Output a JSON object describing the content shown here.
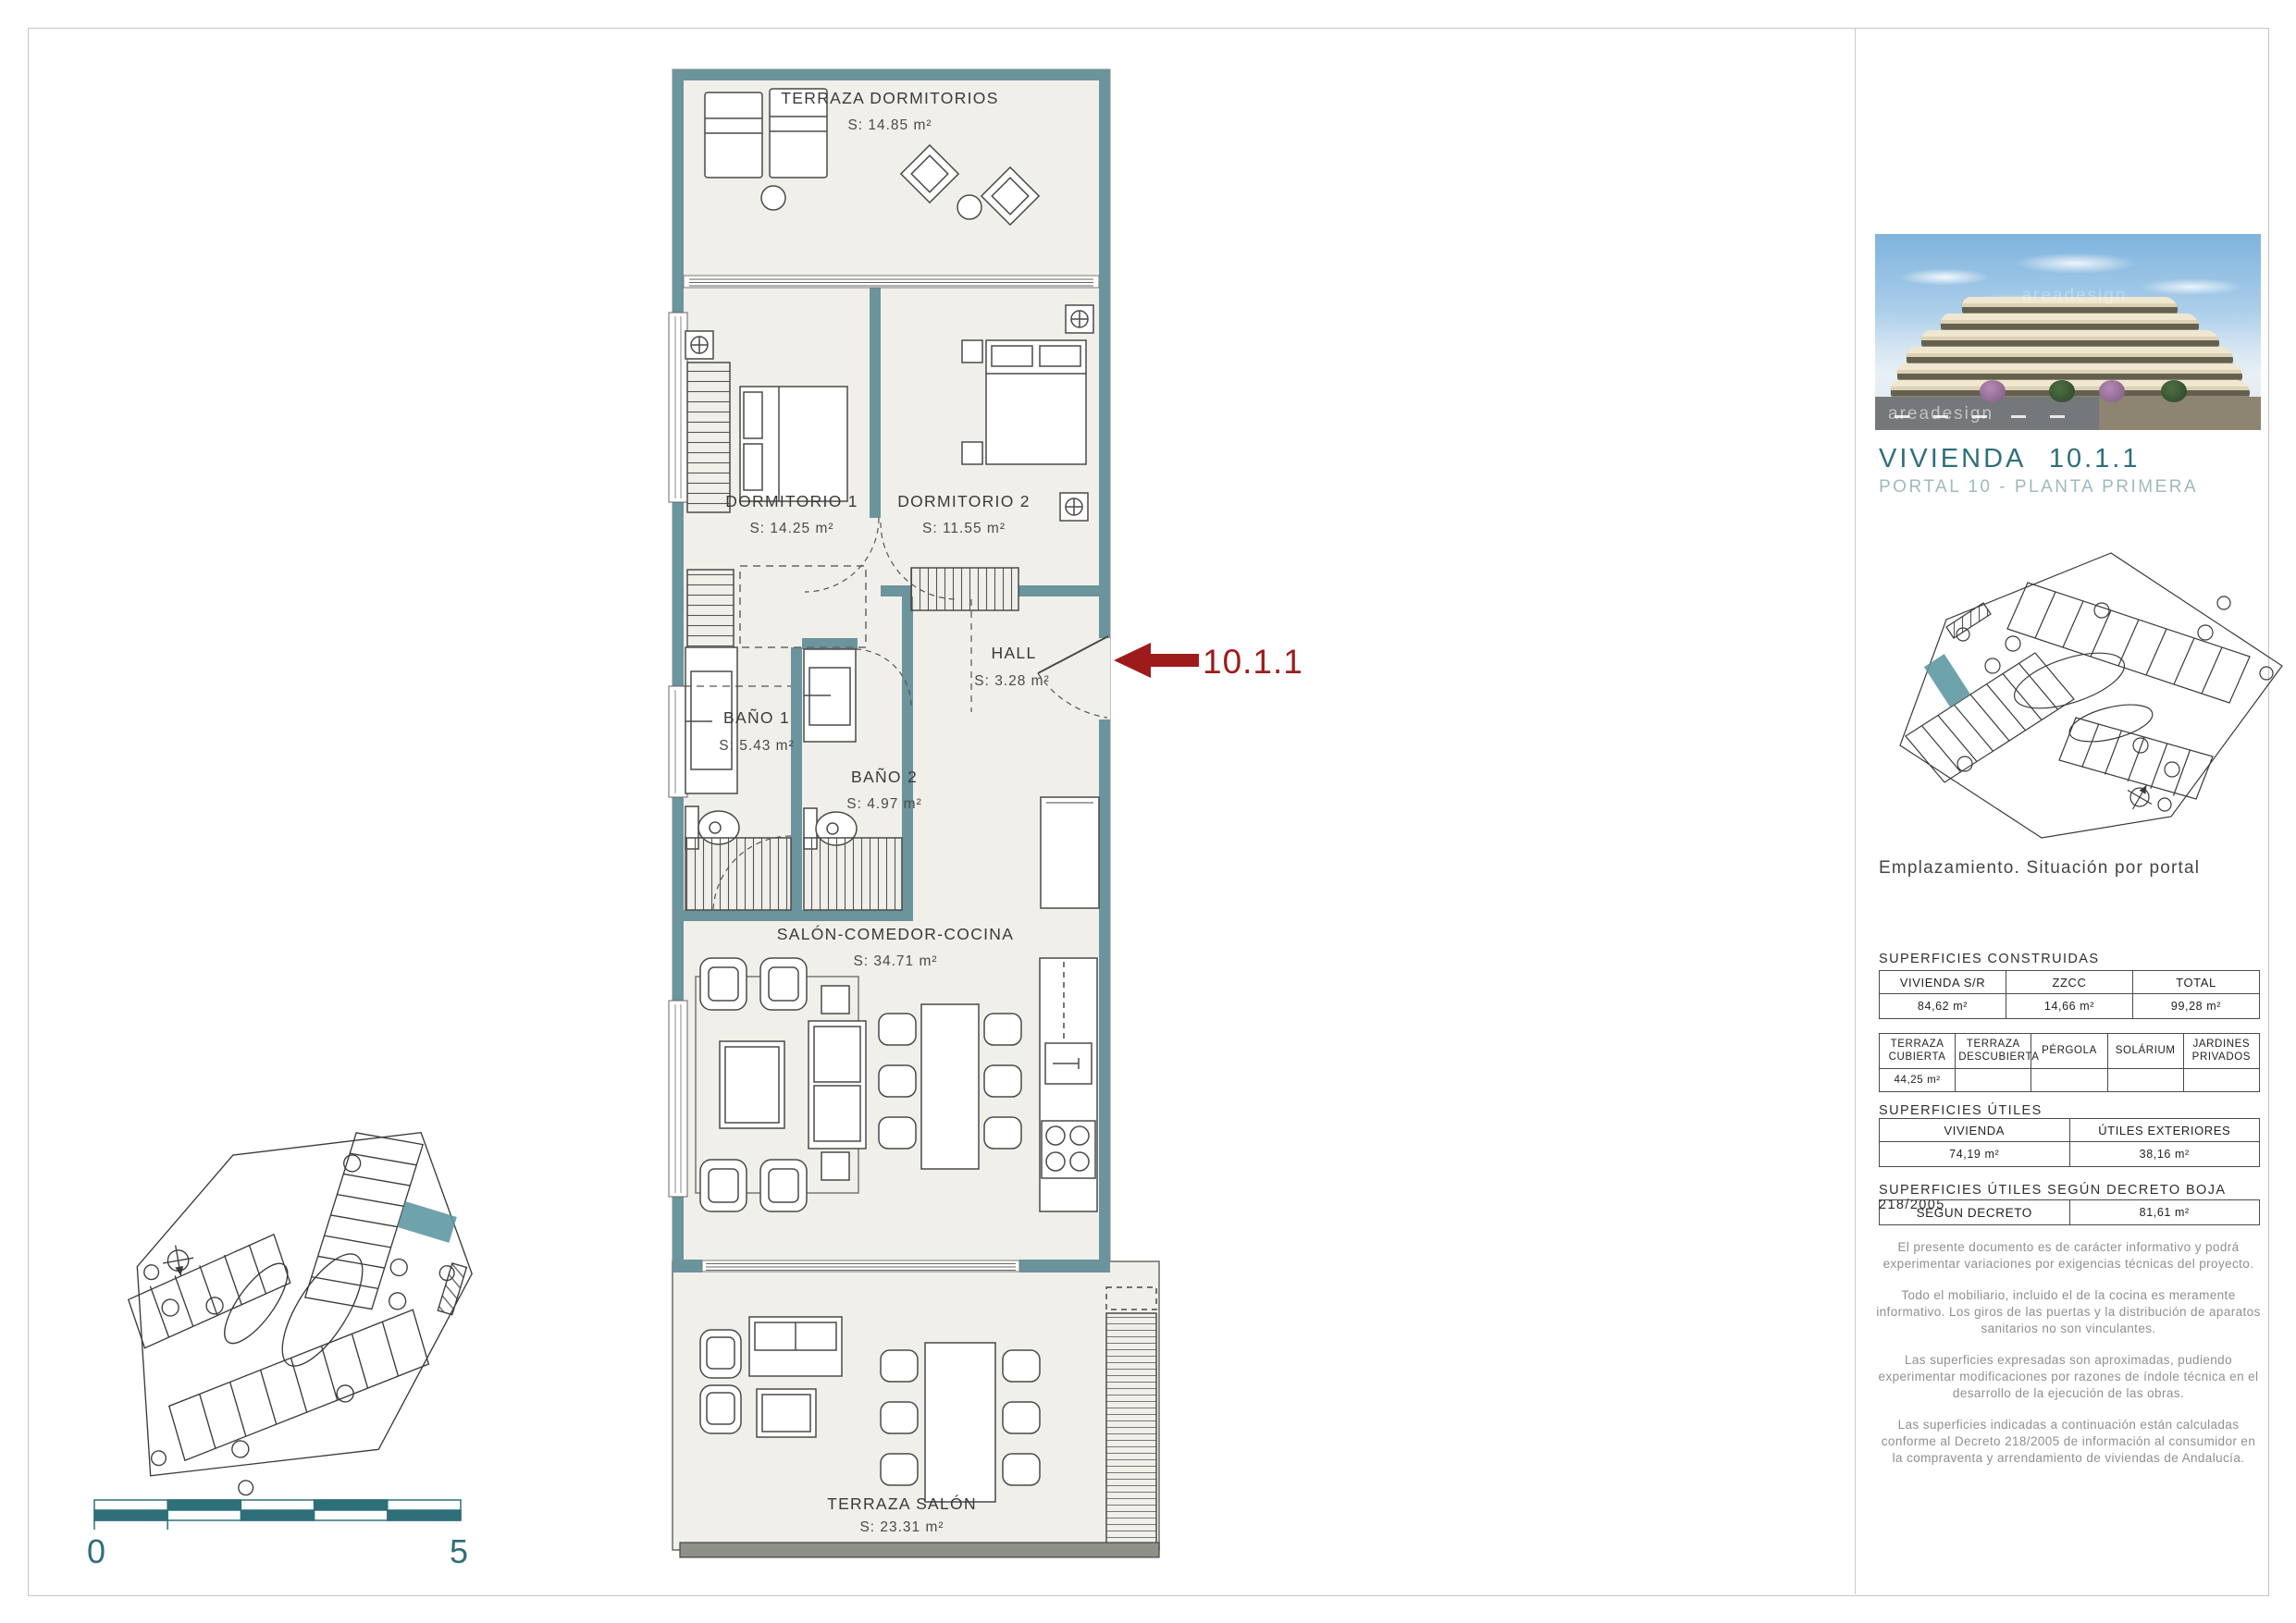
{
  "page": {
    "watermark": "areadesign"
  },
  "panel": {
    "title": "VIVIENDA",
    "unit": "10.1.1",
    "subtitle": "PORTAL 10 - PLANTA PRIMERA",
    "caption": "Emplazamiento. Situación por portal",
    "sections": {
      "constructed": "SUPERFICIES CONSTRUIDAS",
      "useful": "SUPERFICIES ÚTILES",
      "decree": "SUPERFICIES ÚTILES SEGÚN DECRETO BOJA 218/2005"
    },
    "tables": {
      "constructed": {
        "headers": [
          "VIVIENDA S/R",
          "ZZCC",
          "TOTAL"
        ],
        "values": [
          "84,62 m²",
          "14,66 m²",
          "99,28 m²"
        ]
      },
      "terraces": {
        "headers": [
          "TERRAZA CUBIERTA",
          "TERRAZA DESCUBIERTA",
          "PÉRGOLA",
          "SOLÁRIUM",
          "JARDINES PRIVADOS"
        ],
        "values": [
          "44,25 m²",
          "",
          "",
          "",
          ""
        ]
      },
      "useful": {
        "headers": [
          "VIVIENDA",
          "ÚTILES EXTERIORES"
        ],
        "values": [
          "74,19 m²",
          "38,16 m²"
        ]
      },
      "decree": {
        "label": "SEGUN DECRETO",
        "value": "81,61 m²"
      }
    },
    "notes": [
      "El presente documento es de carácter informativo y podrá experimentar variaciones por exigencias técnicas del proyecto.",
      "Todo el mobiliario, incluido el de la cocina es meramente informativo. Los giros de las puertas y la distribución de aparatos sanitarios no son vinculantes.",
      "Las superficies expresadas son aproximadas, pudiendo experimentar modificaciones por razones de índole técnica en el desarrollo de la ejecución de las obras.",
      "Las superficies indicadas a continuación están calculadas conforme al Decreto 218/2005 de información al consumidor en la compraventa y arrendamiento de viviendas de Andalucía."
    ]
  },
  "plan": {
    "entry_label": "10.1.1",
    "rooms": [
      {
        "name": "TERRAZA DORMITORIOS",
        "area": "S: 14.85 m²"
      },
      {
        "name": "DORMITORIO 1",
        "area": "S: 14.25  m²"
      },
      {
        "name": "DORMITORIO 2",
        "area": "S: 11.55  m²"
      },
      {
        "name": "HALL",
        "area": "S:  3.28  m²"
      },
      {
        "name": "BAÑO 1",
        "area": "S:  5.43  m²"
      },
      {
        "name": "BAÑO 2",
        "area": "S:  4.97  m²"
      },
      {
        "name": "SALÓN-COMEDOR-COCINA",
        "area": "S: 34.71  m²"
      },
      {
        "name": "TERRAZA SALÓN",
        "area": "S: 23.31  m²"
      }
    ]
  },
  "scalebar": {
    "min": "0",
    "max": "5"
  },
  "colors": {
    "wall": "#6b949c",
    "accent": "#2e6f7a",
    "arrow": "#9e1b1b",
    "room_fill": "#f1efe9"
  }
}
